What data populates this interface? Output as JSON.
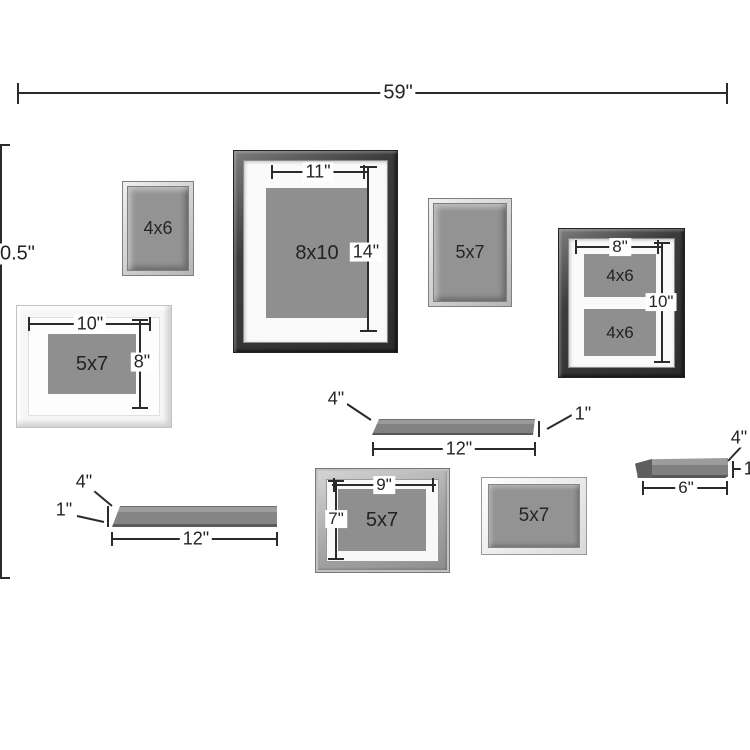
{
  "overall": {
    "width_label": "59\"",
    "height_label": "0.5\""
  },
  "frames": {
    "small_4x6": {
      "opening": "4x6"
    },
    "large_8x10": {
      "opening": "8x10",
      "width": "11\"",
      "height": "14\""
    },
    "small_5x7": {
      "opening": "5x7"
    },
    "double_4x6": {
      "width": "8\"",
      "height": "10\"",
      "opening_top": "4x6",
      "opening_bottom": "4x6"
    },
    "white_5x7": {
      "opening": "5x7",
      "width": "10\"",
      "height": "8\""
    },
    "gray_5x7": {
      "opening": "5x7",
      "width": "9\"",
      "height": "7\""
    },
    "plain_5x7": {
      "opening": "5x7"
    }
  },
  "shelves": {
    "middle": {
      "depth": "4\"",
      "thickness": "1\"",
      "length": "12\""
    },
    "bottom_left": {
      "depth": "4\"",
      "thickness": "1\"",
      "length": "12\""
    },
    "right": {
      "depth": "4\"",
      "thickness": "1\"",
      "length": "6\""
    }
  },
  "colors": {
    "background": "#ffffff",
    "dimension_line": "#2b2b2b",
    "photo_gray": "#8f8f8f",
    "frame_dark": "#3a3a3a",
    "frame_silver": "#c9c9c9",
    "frame_white": "#f6f6f6",
    "frame_gray": "#a8a8a8",
    "mat": "#fafafa"
  }
}
